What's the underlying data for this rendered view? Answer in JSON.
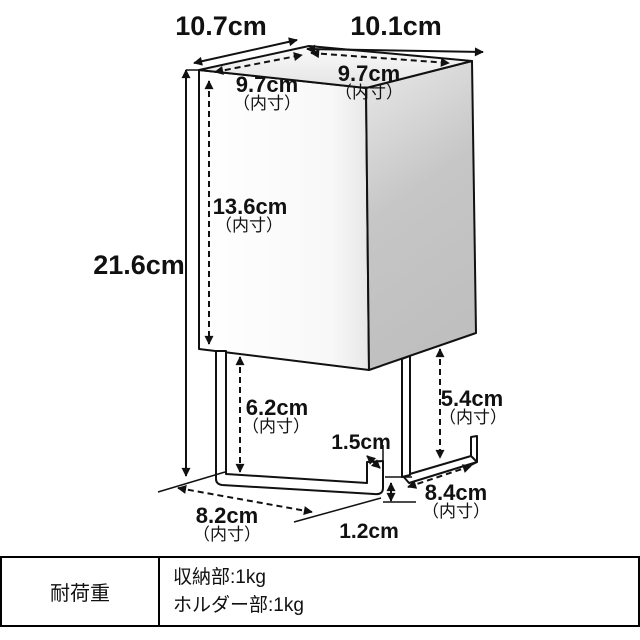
{
  "diagram": {
    "labels": {
      "outer_depth": "10.7cm",
      "outer_width": "10.1cm",
      "inner_depth": "9.7cm",
      "inner_depth_note": "（内寸）",
      "inner_width": "9.7cm",
      "inner_width_note": "（内寸）",
      "inner_height": "13.6cm",
      "inner_height_note": "（内寸）",
      "outer_height": "21.6cm",
      "left_clearance": "6.2cm",
      "left_clearance_note": "（内寸）",
      "hook_lip": "1.5cm",
      "right_clearance": "5.4cm",
      "right_clearance_note": "（内寸）",
      "holder_inner_width": "8.2cm",
      "holder_inner_width_note": "（内寸）",
      "holder_inner_depth": "8.4cm",
      "holder_inner_depth_note": "（内寸）",
      "bar_thickness": "1.2cm"
    }
  },
  "spec_table": {
    "header": "耐荷重",
    "rows": [
      "収納部:1kg",
      "ホルダー部:1kg"
    ]
  },
  "colors": {
    "line": "#111111",
    "box_front": "#ffffff",
    "box_top": "#efefef",
    "box_side": "#c2c2c2",
    "table_border": "#000000",
    "background": "#ffffff"
  }
}
